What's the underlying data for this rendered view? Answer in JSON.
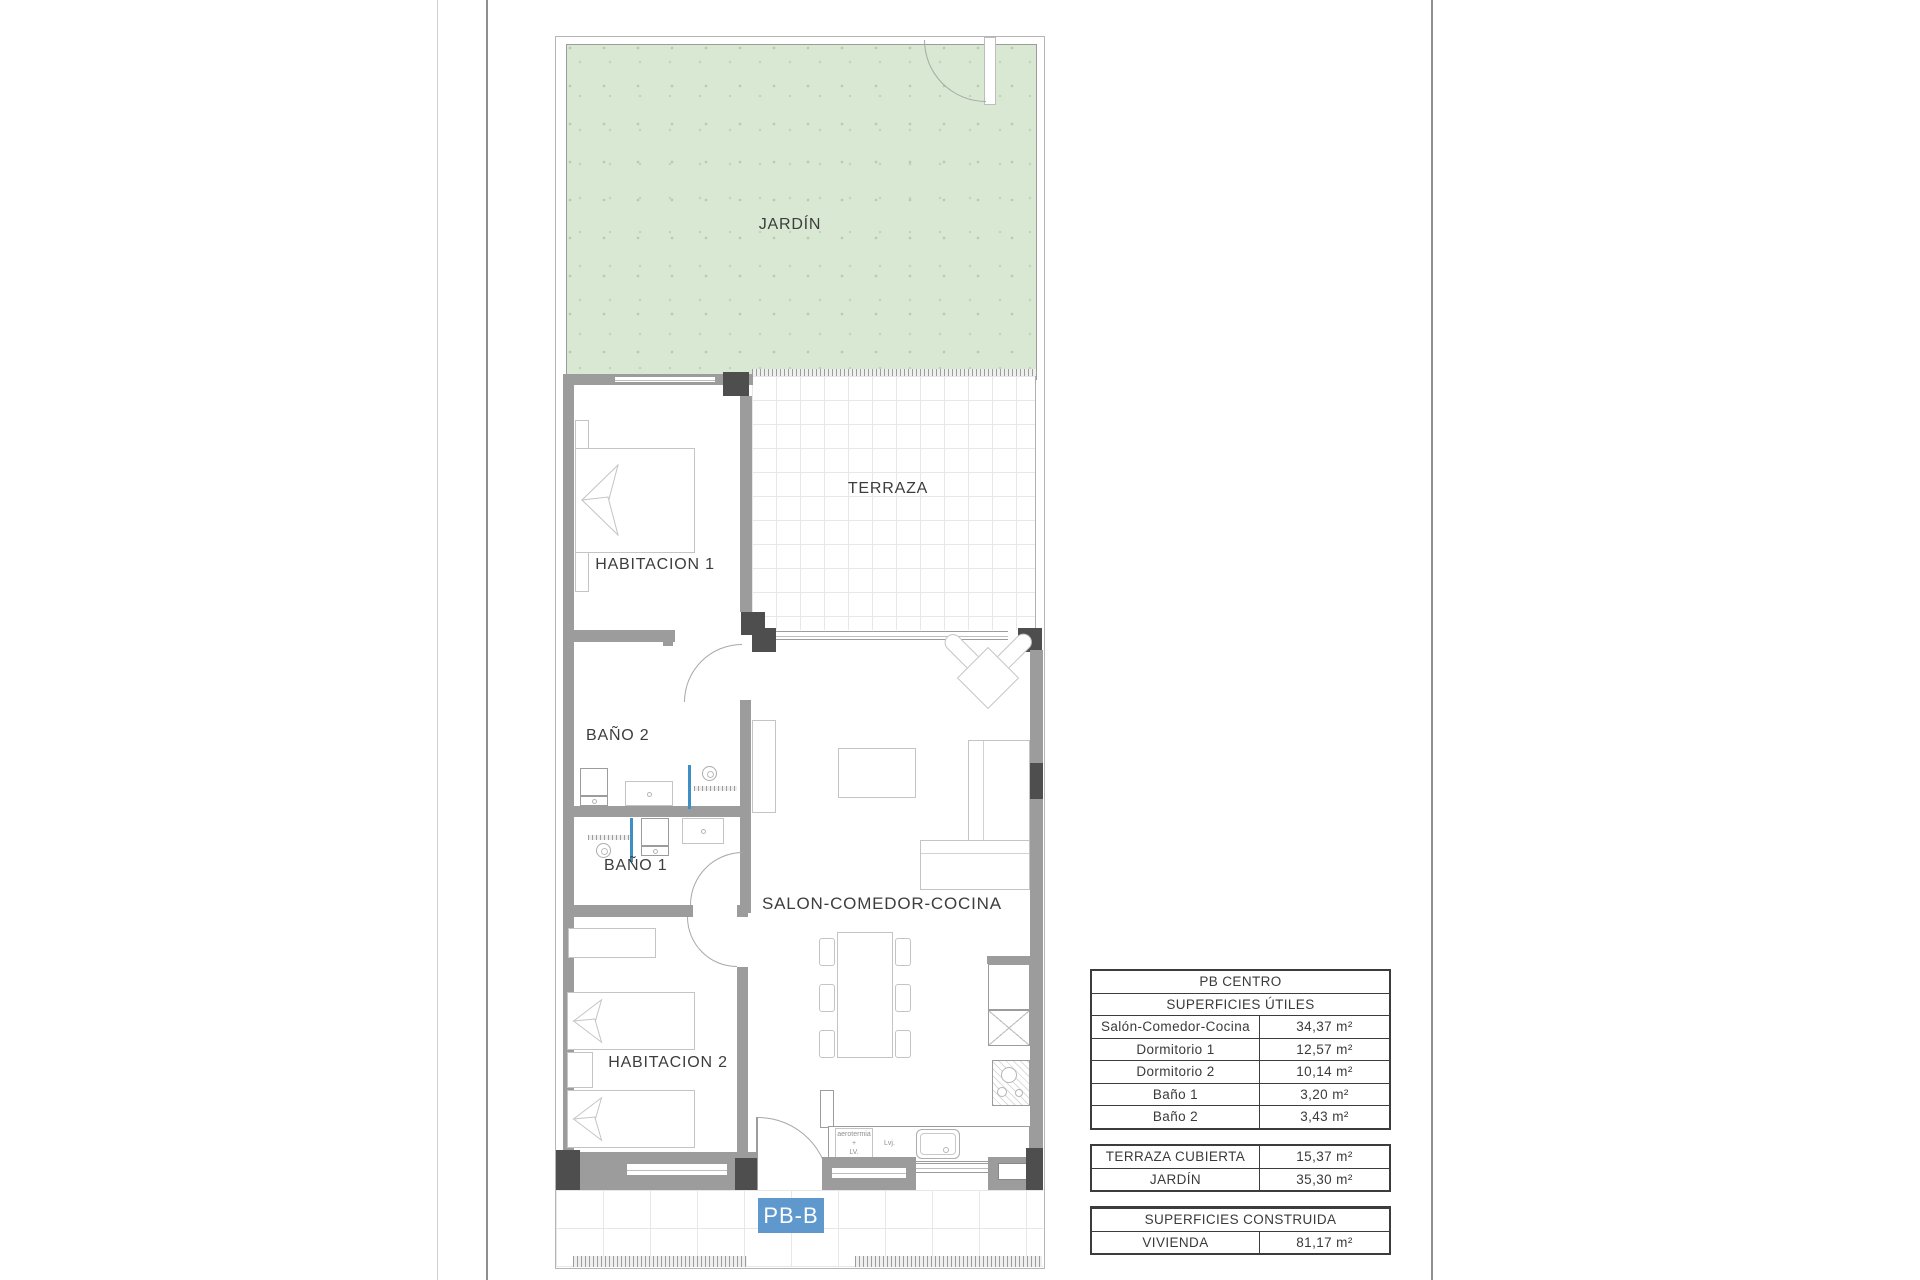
{
  "plan": {
    "labels": {
      "jardin": "JARDÍN",
      "terraza": "TERRAZA",
      "habitacion1": "HABITACION 1",
      "bano2": "BAÑO 2",
      "bano1": "BAÑO 1",
      "habitacion2": "HABITACION 2",
      "salon": "SALON-COMEDOR-COCINA"
    },
    "kitchen": {
      "aerotermia_lv": "aerotermia\n+\nLV.",
      "lvj": "Lvj."
    },
    "unit_badge": "PB-B",
    "colors": {
      "garden_green": "#d8e8d2",
      "badge_blue": "#5f98cd",
      "wall_gray": "#9c9c9c",
      "pillar_dark": "#4e4e4e",
      "shower_blue": "#3e8fc4"
    }
  },
  "tables": {
    "useful": {
      "title": "PB CENTRO",
      "subtitle": "SUPERFICIES ÚTILES",
      "rows": [
        {
          "label": "Salón-Comedor-Cocina",
          "value": "34,37 m²"
        },
        {
          "label": "Dormitorio 1",
          "value": "12,57 m²"
        },
        {
          "label": "Dormitorio 2",
          "value": "10,14 m²"
        },
        {
          "label": "Baño 1",
          "value": "3,20 m²"
        },
        {
          "label": "Baño 2",
          "value": "3,43 m²"
        }
      ]
    },
    "exterior": {
      "rows": [
        {
          "label": "TERRAZA CUBIERTA",
          "value": "15,37 m²"
        },
        {
          "label": "JARDÍN",
          "value": "35,30 m²"
        }
      ]
    },
    "built": {
      "title": "SUPERFICIES CONSTRUIDA",
      "rows": [
        {
          "label": "VIVIENDA",
          "value": "81,17 m²"
        }
      ]
    }
  }
}
